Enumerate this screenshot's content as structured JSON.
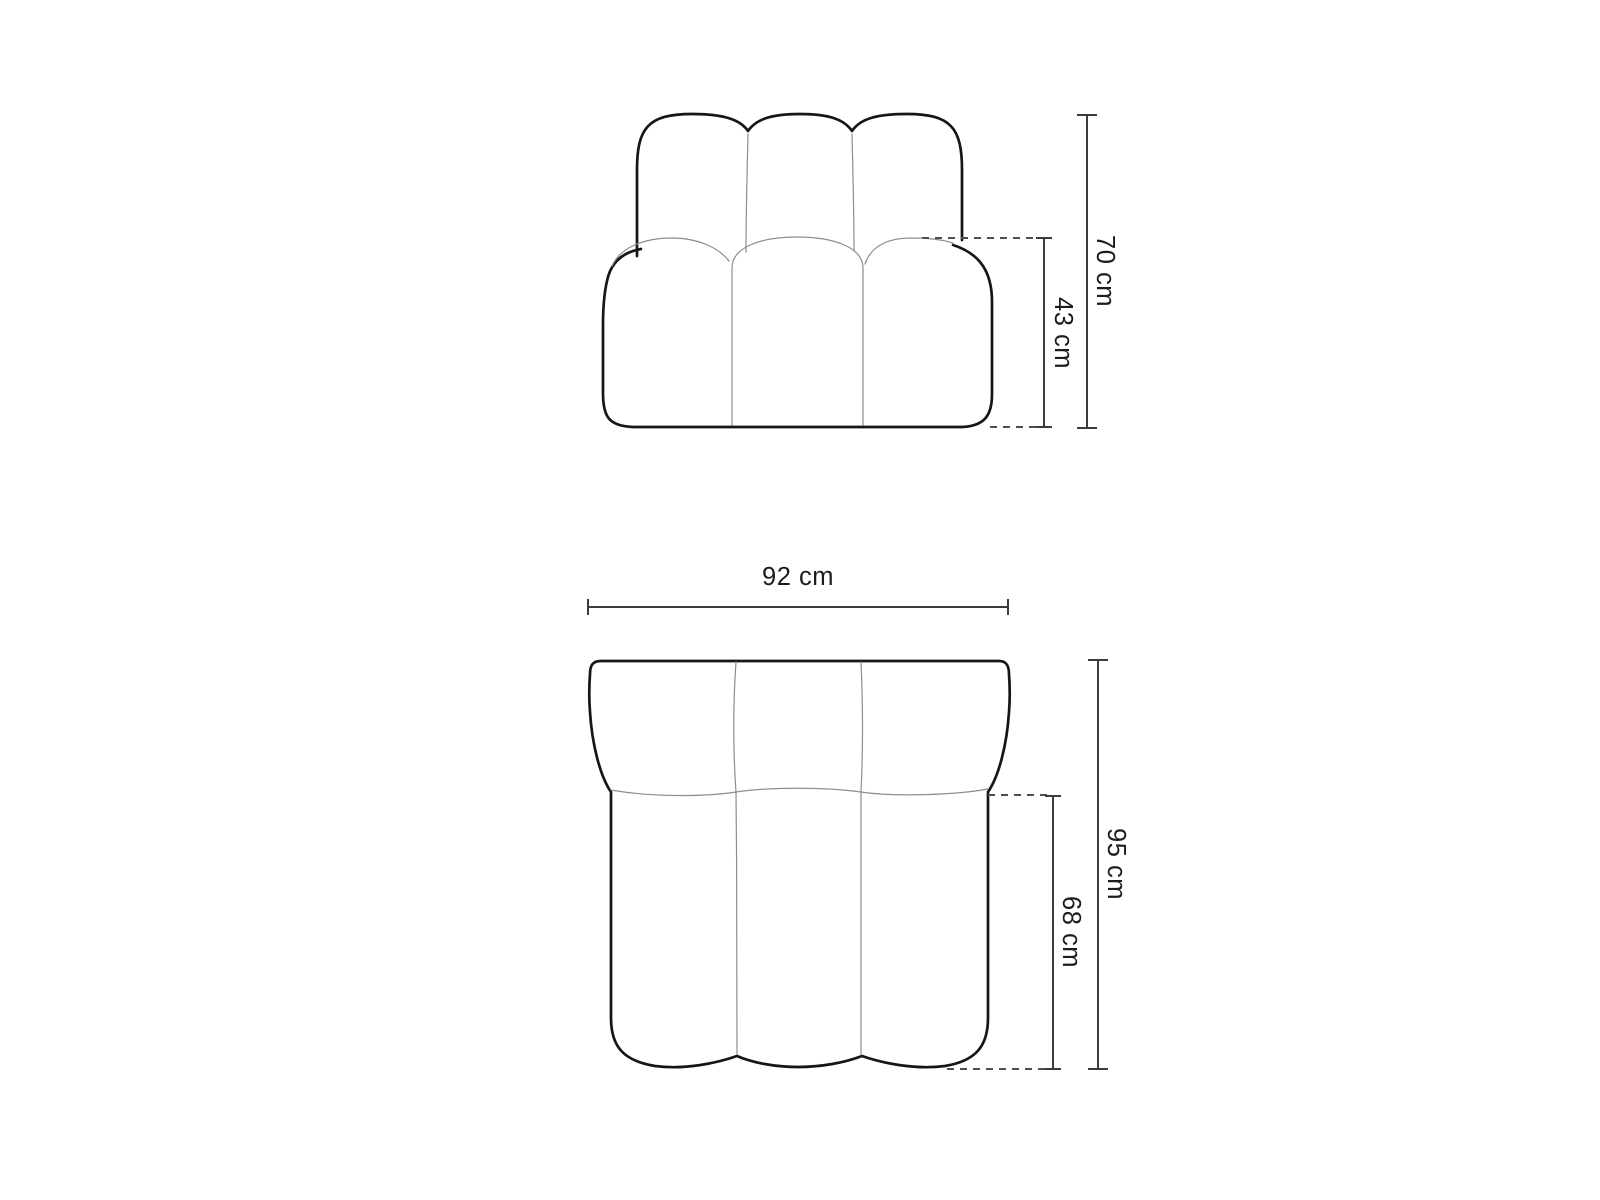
{
  "canvas": {
    "width": 1600,
    "height": 1200,
    "background": "#ffffff"
  },
  "diagram": {
    "kind": "furniture dimension drawing",
    "subject": "modular sofa element shown in front view and top view",
    "front_view": {
      "overall_height_label": "70 cm",
      "seat_height_label": "43 cm"
    },
    "top_view": {
      "overall_width_label": "92 cm",
      "overall_depth_label": "95 cm",
      "seat_depth_label": "68 cm"
    },
    "colors": {
      "outline": "#161616",
      "seam": "#8d8d8d",
      "dimension_line": "#3c3c3c",
      "dashed_line": "#4f4f4f",
      "label_text": "#1c1c1c",
      "background": "#ffffff"
    }
  }
}
